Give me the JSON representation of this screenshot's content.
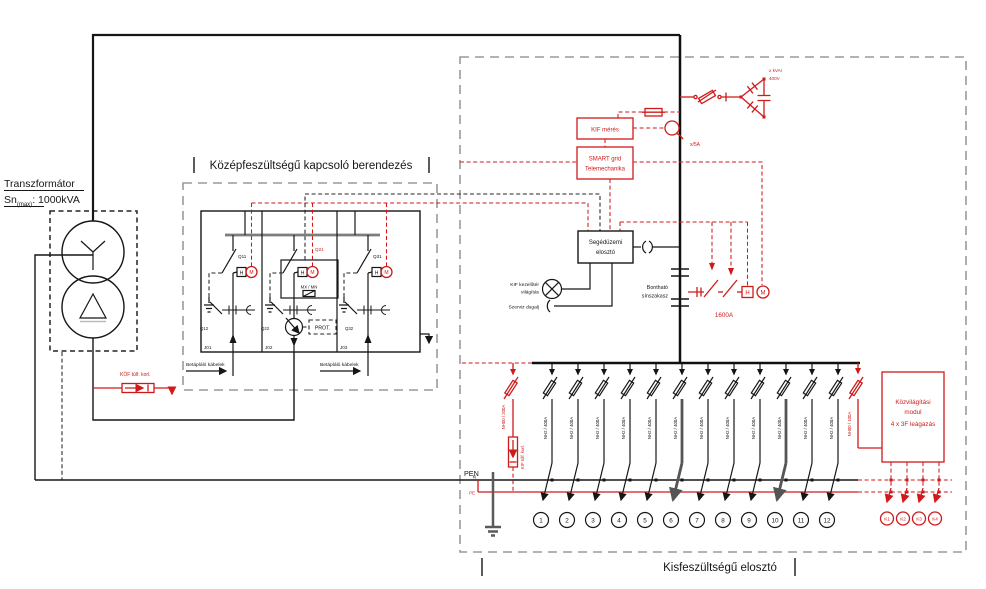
{
  "transformer": {
    "title": "Transzformátor",
    "sn": "Sn",
    "sn_sub": "(max)",
    "sn_rest": ": 1000kVA"
  },
  "sym": {
    "h": "H",
    "m": "M"
  },
  "mv": {
    "title": "Középfeszültségű kapcsoló berendezés",
    "q11": "Q11",
    "q12": "Q12",
    "q21": "Q21",
    "q22": "Q22",
    "q31": "Q31",
    "q32": "Q32",
    "j01": "J01",
    "j02": "J02",
    "j03": "J03",
    "cable": "Betápláló kábelek",
    "relay": "MX / MN",
    "prot": "PROT.",
    "arrester": "KÖF túlf. korl."
  },
  "lv": {
    "title": "Kisfeszültségű elosztó",
    "meter": "KIF mérés",
    "smart1": "SMART grid",
    "smart2": "Telemechanika",
    "aux1": "Segédüzemi",
    "aux2": "elosztó",
    "ct": "x/5A",
    "cap1": "x kVAr",
    "cap2": "400V",
    "breaker": "1600A",
    "split1": "Bontható",
    "split2": "sínszakasz",
    "lamp1": "KIF kezelőtér",
    "lamp2": "világítás",
    "socket": "Szerviz dugalj",
    "pen": "PEN",
    "n": "N",
    "pe": "PE",
    "arrester_fuse": "NH00 / 200A",
    "arrester": "KIF túlf. korl.",
    "feeder_fuse": "NH2 / 400A",
    "feeders": [
      "1",
      "2",
      "3",
      "4",
      "5",
      "6",
      "7",
      "8",
      "9",
      "10",
      "11",
      "12"
    ],
    "lighting": {
      "l1": "Közvilágítási",
      "l2": "modul",
      "l3": "4 x 3F leágazás",
      "fuse": "NH00 / 100A",
      "outputs": [
        "K1",
        "K2",
        "K3",
        "K4"
      ]
    }
  },
  "colors": {
    "accent_red": "#cf1a1a",
    "line_black": "#161616",
    "frame_gray": "#9a9a9a"
  }
}
